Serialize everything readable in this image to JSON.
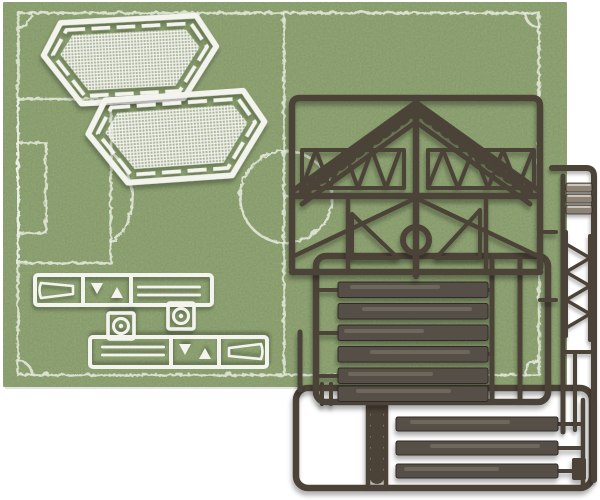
{
  "scene": {
    "subject": "Sports-field model kit photo: plastic part sprues lying on a miniature grass football pitch mat",
    "objects": [
      {
        "id": "pitch-mat",
        "label": "green grass football pitch mat with white chalk field markings"
      },
      {
        "id": "goal-net-piece-1",
        "label": "white flat goal-net mesh panel, hexagonal outline"
      },
      {
        "id": "goal-net-piece-2",
        "label": "white flat goal-net mesh panel, hexagonal outline"
      },
      {
        "id": "white-parts-sprue-1",
        "label": "white sprue with goal side frame, two corner flags, two post rods and ball disc"
      },
      {
        "id": "white-parts-sprue-2",
        "label": "identical white sprue rotated 180 degrees"
      },
      {
        "id": "dark-sprue-trusses",
        "label": "dark brown sprue with roof girders, lattice trusses and a ring piece"
      },
      {
        "id": "dark-sprue-steps",
        "label": "dark brown sprue holding six wide terrace step planks"
      },
      {
        "id": "dark-sprue-planks",
        "label": "dark brown sprue holding three long barrier planks and a ladder piece"
      },
      {
        "id": "dark-sprue-edge",
        "label": "partial dark sprue entering from the right edge with lattice and slat parts"
      }
    ],
    "counts": {
      "goal_net_panels": 2,
      "white_sprues": 2,
      "terrace_step_planks": 6,
      "long_barrier_planks": 3,
      "corner_flags_per_white_sprue": 2,
      "post_rods_per_white_sprue": 2
    }
  },
  "pitch": {
    "markings": [
      "boundary",
      "halfway-line",
      "centre-circle",
      "centre-spot",
      "penalty-area",
      "goal-area",
      "penalty-arc",
      "corner-arcs"
    ]
  },
  "colors": {
    "background": "#ffffff",
    "grass_base": "#55703f",
    "grass_dark": "#3e5230",
    "grass_light": "#7e9355",
    "line": "#edefe5",
    "white_plastic": "#f4f4ef",
    "sprue": "#4b4339",
    "sprue_dark": "#312b25",
    "sprue_light": "#8c8276",
    "plank": "#575046",
    "plank_light": "#8c8276"
  }
}
